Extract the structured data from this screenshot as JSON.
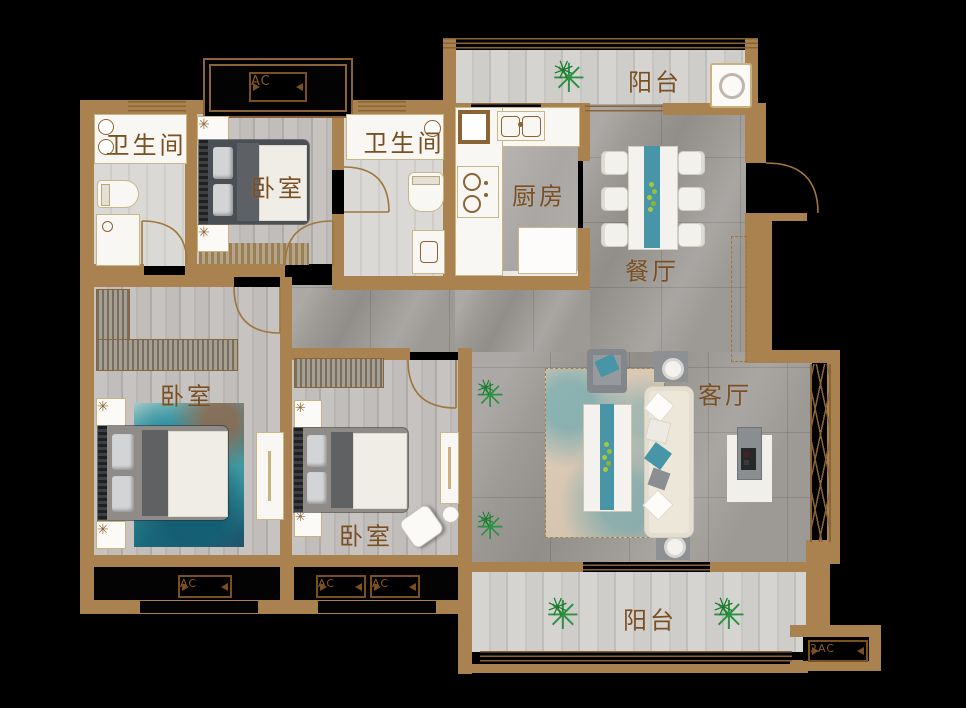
{
  "colors": {
    "wall": "#a9824f",
    "window_line": "#8a6434",
    "label_text": "#7a4f21",
    "door_arc": "#a0763f",
    "accent_teal": "#4795a6",
    "plant_green": "#2c9140",
    "floor_gray": "#9d9a96",
    "fixture_white": "#f8f7f3",
    "sofa_cream": "#ece7d9",
    "rug_teal_dark": "#1d6f80"
  },
  "rooms": {
    "balcony_top": {
      "label": "阳台"
    },
    "bathroom_left": {
      "label": "卫生间"
    },
    "bedroom_top": {
      "label": "卧室"
    },
    "bathroom_mid": {
      "label": "卫生间"
    },
    "kitchen": {
      "label": "厨房"
    },
    "dining": {
      "label": "餐厅"
    },
    "bedroom_left": {
      "label": "卧室"
    },
    "bedroom_mid": {
      "label": "卧室"
    },
    "living": {
      "label": "客厅"
    },
    "balcony_bottom": {
      "label": "阳台"
    }
  },
  "ac_platforms": {
    "top": {
      "label": "AC"
    },
    "bottom_left": {
      "label": "AC"
    },
    "bottom_mid_a": {
      "label": "AC"
    },
    "bottom_mid_b": {
      "label": "AC"
    },
    "bottom_right": {
      "label": "2AC"
    }
  }
}
